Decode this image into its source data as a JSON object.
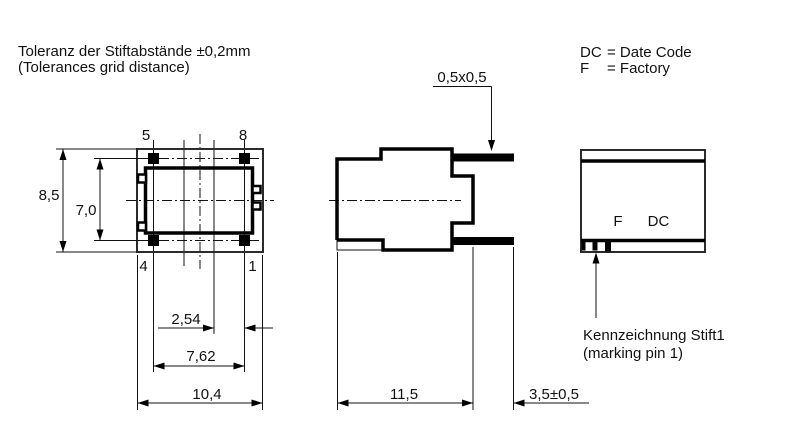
{
  "notes": {
    "tolerance_line1": "Toleranz der Stiftabstände ±0,2mm",
    "tolerance_line2": "(Tolerances grid distance)",
    "legend_dc_key": "DC",
    "legend_dc_val": "= Date Code",
    "legend_f_key": "F",
    "legend_f_val": "= Factory",
    "marking_line1": "Kennzeichnung Stift1",
    "marking_line2": "(marking pin 1)"
  },
  "top_view": {
    "pin_top_left": "5",
    "pin_top_right": "8",
    "pin_bottom_left": "4",
    "pin_bottom_right": "1",
    "dim_height": "8,5",
    "dim_pin_row_span": "7,0",
    "dim_pin_pitch": "2,54",
    "dim_pin_span": "7,62",
    "dim_width": "10,4"
  },
  "side_view": {
    "dim_pin_section": "0,5x0,5",
    "dim_body_length": "11,5",
    "dim_pin_length": "3,5±0,5"
  },
  "front_view": {
    "mark_f": "F",
    "mark_dc": "DC"
  },
  "colors": {
    "line": "#000000",
    "background": "#ffffff"
  }
}
